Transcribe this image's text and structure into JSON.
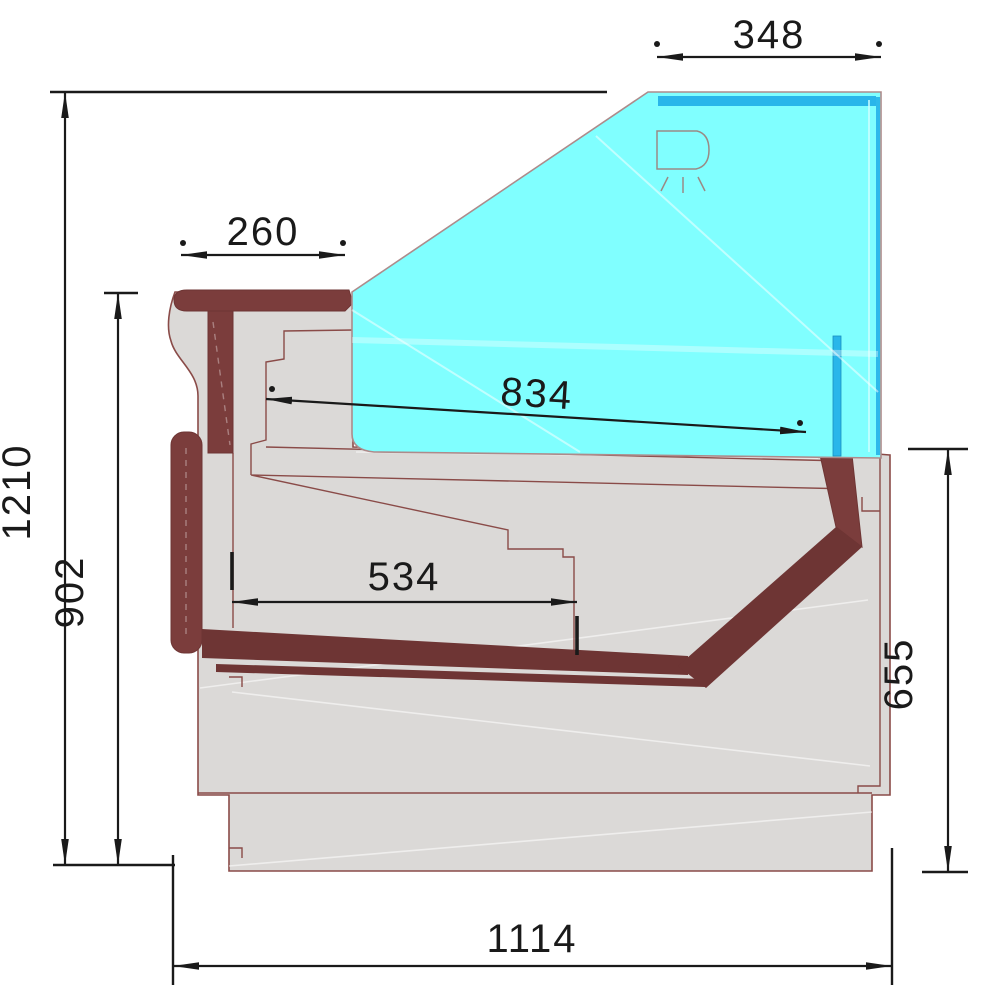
{
  "diagram": {
    "dimensions_mm": {
      "canopy_width": "348",
      "counter_depth": "260",
      "glass_length": "834",
      "shelf_depth": "534",
      "overall_height": "1210",
      "counter_height": "902",
      "rear_height": "655",
      "overall_depth": "1114"
    },
    "colors": {
      "glass": "#80FFFF",
      "glass_accent": "#29B6EA",
      "body": "#DBD9D7",
      "trim": "#7B3D3C",
      "trim_dark": "#6E3534",
      "outline": "#8A4B48",
      "dim": "#1A1A1A"
    },
    "icons": [
      "lamp-icon"
    ]
  }
}
